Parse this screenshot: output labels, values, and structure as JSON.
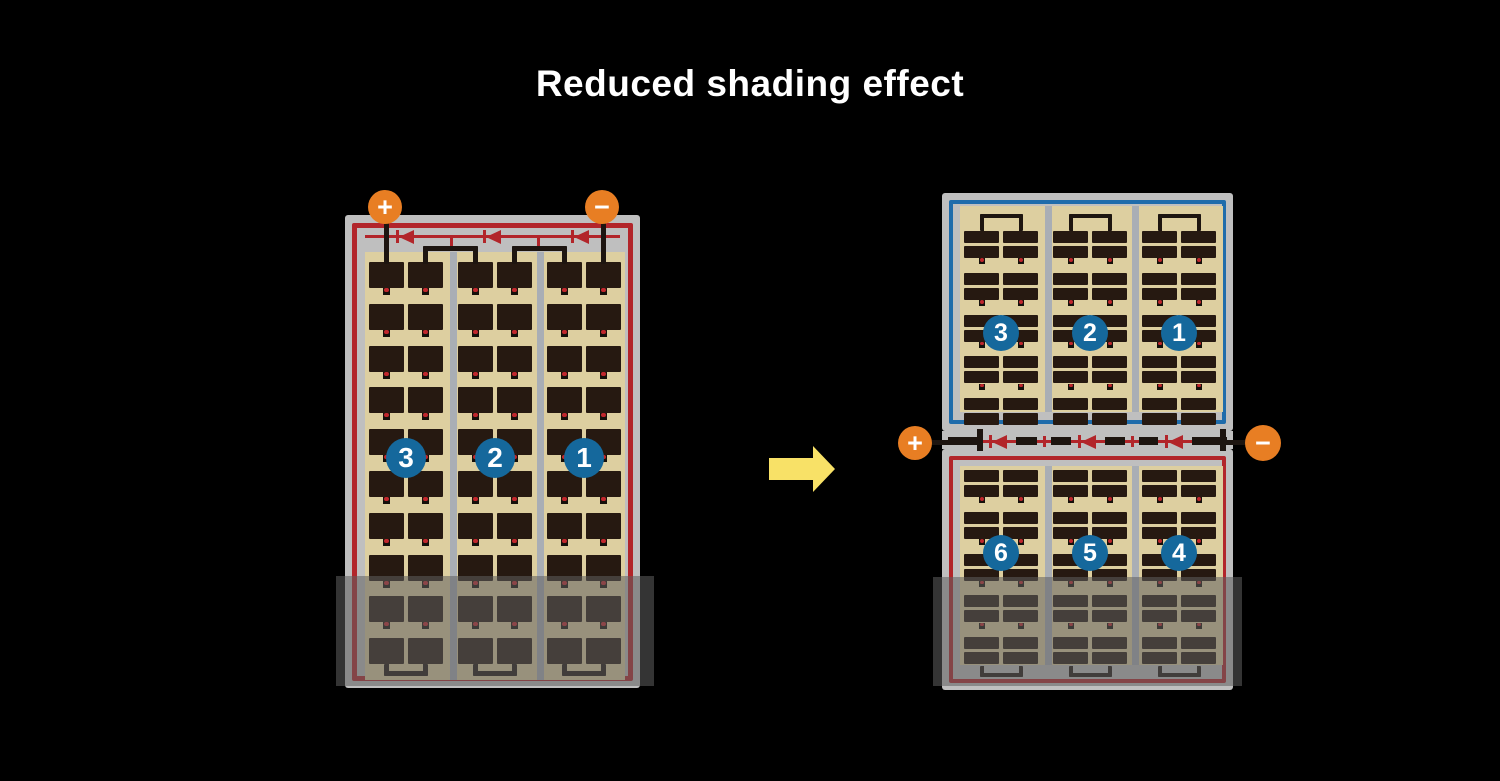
{
  "title": "Reduced shading effect",
  "colors": {
    "background": "#000000",
    "frame_gray": "#bfbfbf",
    "gutter_gray": "#a9aeb5",
    "cell_area_beige": "#ddcfa0",
    "cell_dark": "#261911",
    "wire_black": "#1d1510",
    "circuit_red": "#b2252a",
    "series_blue": "#1f6cab",
    "number_circle_blue": "#15689c",
    "terminal_orange": "#e87e23",
    "arrow_yellow": "#f8e167",
    "shade_overlay": "rgba(95,95,95,0.55)",
    "dot_red": "#c0272d"
  },
  "left_panel": {
    "string_numbers": [
      "3",
      "2",
      "1"
    ],
    "num_strings": 3,
    "cell_rows": 10,
    "diode_count": 3,
    "terminals": [
      {
        "sign": "+"
      },
      {
        "sign": "−"
      }
    ]
  },
  "right_panel": {
    "top_half": {
      "string_numbers": [
        "3",
        "2",
        "1"
      ],
      "cell_rows": 10
    },
    "bottom_half": {
      "string_numbers": [
        "6",
        "5",
        "4"
      ],
      "cell_rows": 10
    },
    "num_strings": 3,
    "diode_count": 3,
    "terminals": [
      {
        "sign": "+"
      },
      {
        "sign": "−"
      }
    ]
  },
  "arrow": {
    "direction": "right"
  }
}
